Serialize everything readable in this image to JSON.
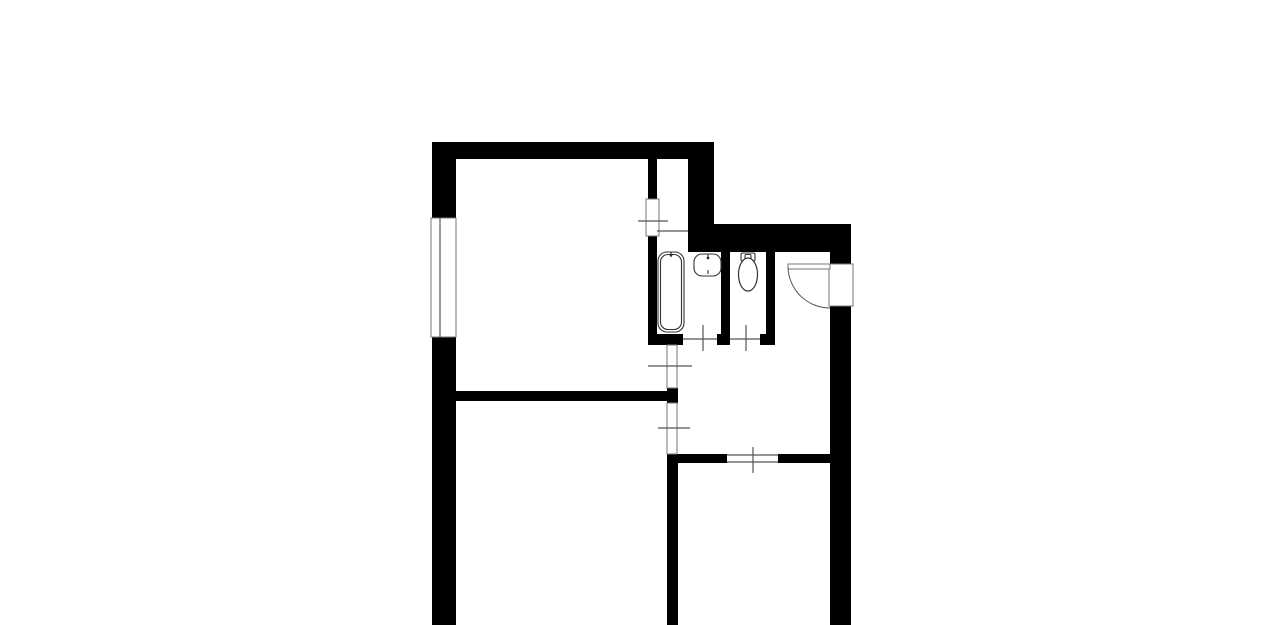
{
  "canvas": {
    "width": 1280,
    "height": 625
  },
  "plan": {
    "colors": {
      "wall": "#000000",
      "background": "#ffffff",
      "line": "#555555",
      "frame": "#777777",
      "fixture": "#333333"
    },
    "walls": [
      {
        "name": "top-wall",
        "x": 432,
        "y": 142,
        "w": 282,
        "h": 17
      },
      {
        "name": "left-wall-upper",
        "x": 432,
        "y": 142,
        "w": 24,
        "h": 76
      },
      {
        "name": "left-wall-lower",
        "x": 432,
        "y": 337,
        "w": 24,
        "h": 288
      },
      {
        "name": "room1-closet-wall",
        "x": 648,
        "y": 159,
        "w": 9,
        "h": 40
      },
      {
        "name": "room1-bathroom-wall",
        "x": 648,
        "y": 236,
        "w": 9,
        "h": 98
      },
      {
        "name": "corner-column",
        "x": 688,
        "y": 142,
        "w": 26,
        "h": 110
      },
      {
        "name": "bathroom-top-wall",
        "x": 688,
        "y": 224,
        "w": 163,
        "h": 28
      },
      {
        "name": "right-wall-upper",
        "x": 830,
        "y": 252,
        "w": 21,
        "h": 12
      },
      {
        "name": "right-wall-lower",
        "x": 830,
        "y": 306,
        "w": 21,
        "h": 319
      },
      {
        "name": "bathroom-bottom-wall-left",
        "x": 648,
        "y": 334,
        "w": 35,
        "h": 11
      },
      {
        "name": "bathroom-bottom-wall-mid",
        "x": 717,
        "y": 334,
        "w": 13,
        "h": 11
      },
      {
        "name": "bathroom-bottom-wall-right",
        "x": 760,
        "y": 334,
        "w": 15,
        "h": 11
      },
      {
        "name": "wc-left-wall",
        "x": 721,
        "y": 252,
        "w": 9,
        "h": 82
      },
      {
        "name": "wc-right-wall",
        "x": 766,
        "y": 252,
        "w": 9,
        "h": 93
      },
      {
        "name": "room-divider-wall",
        "x": 456,
        "y": 391,
        "w": 211,
        "h": 10
      },
      {
        "name": "divider-wall-nub",
        "x": 667,
        "y": 388,
        "w": 11,
        "h": 15
      },
      {
        "name": "hall-bottom-wall-left",
        "x": 667,
        "y": 454,
        "w": 60,
        "h": 9
      },
      {
        "name": "hall-bottom-wall-right",
        "x": 778,
        "y": 454,
        "w": 52,
        "h": 9
      },
      {
        "name": "middle-lower-wall",
        "x": 667,
        "y": 454,
        "w": 11,
        "h": 171
      }
    ],
    "openings": [
      {
        "name": "window-left-wall",
        "x": 431,
        "y": 218,
        "w": 25,
        "h": 119
      },
      {
        "name": "room1-closet-doorway",
        "x": 646,
        "y": 199,
        "w": 13,
        "h": 37
      },
      {
        "name": "entry-door-opening",
        "x": 829,
        "y": 264,
        "w": 24,
        "h": 42
      },
      {
        "name": "hall-opening-upper",
        "x": 667,
        "y": 345,
        "w": 10,
        "h": 43
      },
      {
        "name": "hall-opening-lower",
        "x": 667,
        "y": 403,
        "w": 10,
        "h": 51
      },
      {
        "name": "entry-door-leaf",
        "x": 788,
        "y": 264,
        "w": 42,
        "h": 5
      }
    ],
    "thin_lines": [
      {
        "name": "window-midline",
        "x1": 440,
        "y1": 218,
        "x2": 440,
        "y2": 337
      },
      {
        "name": "closet-bottom-line",
        "x1": 657,
        "y1": 231,
        "x2": 688,
        "y2": 231
      },
      {
        "name": "closet-door-tick",
        "x1": 638,
        "y1": 221,
        "x2": 668,
        "y2": 221
      },
      {
        "name": "upper-opening-tick",
        "x1": 648,
        "y1": 366,
        "x2": 692,
        "y2": 366
      },
      {
        "name": "lower-opening-tick",
        "x1": 658,
        "y1": 428,
        "x2": 690,
        "y2": 428
      },
      {
        "name": "bath-door-tick",
        "x1": 703,
        "y1": 325,
        "x2": 703,
        "y2": 351
      },
      {
        "name": "wc-door-tick",
        "x1": 746,
        "y1": 325,
        "x2": 746,
        "y2": 351
      },
      {
        "name": "room3-door-tick",
        "x1": 753,
        "y1": 447,
        "x2": 753,
        "y2": 473
      },
      {
        "name": "bath-door-threshold",
        "x1": 683,
        "y1": 339,
        "x2": 717,
        "y2": 339
      },
      {
        "name": "wc-door-threshold",
        "x1": 730,
        "y1": 339,
        "x2": 760,
        "y2": 339
      },
      {
        "name": "room3-door-threshold-top",
        "x1": 727,
        "y1": 455,
        "x2": 778,
        "y2": 455
      },
      {
        "name": "room3-door-threshold-bottom",
        "x1": 727,
        "y1": 462,
        "x2": 778,
        "y2": 462
      }
    ],
    "arcs": [
      {
        "name": "entry-door-swing-arc",
        "d": "M 788 267 A 42 42 0 0 0 830 308"
      }
    ],
    "fixtures": [
      {
        "name": "bathtub-outer",
        "type": "rrect",
        "x": 658,
        "y": 252,
        "w": 26,
        "h": 80,
        "rx": 9,
        "fill": true
      },
      {
        "name": "bathtub-inner",
        "type": "rrect",
        "x": 660.5,
        "y": 254.5,
        "w": 21,
        "h": 75,
        "rx": 7.5,
        "fill": false
      },
      {
        "name": "bathtub-tap",
        "type": "line",
        "x1": 671,
        "y1": 252,
        "x2": 671,
        "y2": 257
      },
      {
        "name": "bathtub-tap-dot",
        "type": "circle",
        "cx": 671,
        "cy": 255,
        "r": 1.4
      },
      {
        "name": "sink-basin",
        "type": "rrect",
        "x": 694,
        "y": 254,
        "w": 27,
        "h": 22,
        "rx": 8,
        "fill": true
      },
      {
        "name": "sink-tap",
        "type": "line",
        "x1": 708,
        "y1": 254,
        "x2": 708,
        "y2": 258
      },
      {
        "name": "sink-tap-dot",
        "type": "circle",
        "cx": 708,
        "cy": 258,
        "r": 1.4
      },
      {
        "name": "sink-drain",
        "type": "line",
        "x1": 708,
        "y1": 270,
        "x2": 708,
        "y2": 274
      },
      {
        "name": "toilet-tank",
        "type": "rrect",
        "x": 741,
        "y": 253,
        "w": 14,
        "h": 8,
        "rx": 1.5,
        "fill": true
      },
      {
        "name": "toilet-tank-detail",
        "type": "rrect",
        "x": 745,
        "y": 254.5,
        "w": 6,
        "h": 4,
        "rx": 1,
        "fill": false
      },
      {
        "name": "toilet-bowl",
        "type": "ellipse",
        "cx": 748,
        "cy": 274.5,
        "rx": 9.5,
        "ry": 16.5
      }
    ]
  }
}
